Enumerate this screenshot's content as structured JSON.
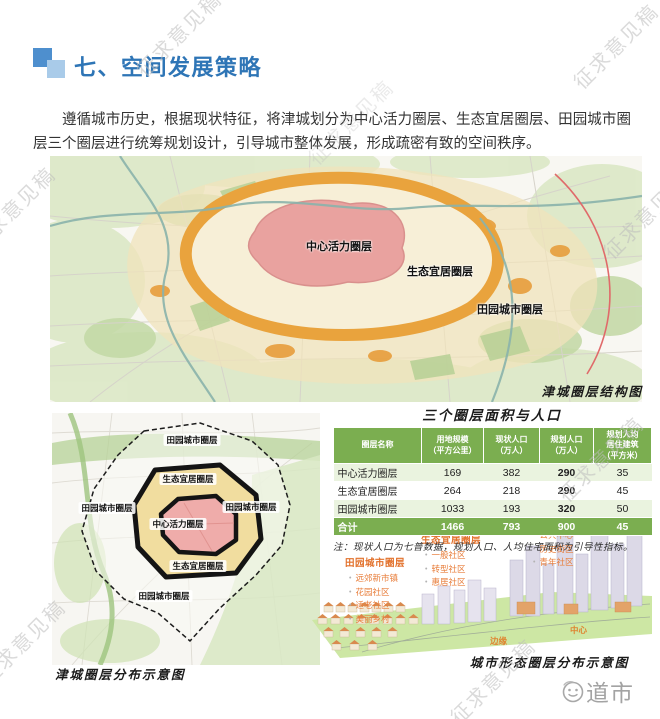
{
  "watermark": {
    "text": "征求意见稿"
  },
  "colors": {
    "accent_blue": "#2e75b6",
    "table_green": "#7bae50",
    "highlight_orange": "#e2702a"
  },
  "header": {
    "title": "七、空间发展策略"
  },
  "intro": {
    "text": "遵循城市历史，根据现状特征，将津城划分为中心活力圈层、生态宜居圈层、田园城市圈层三个圈层进行统筹规划设计，引导城市整体发展，形成疏密有致的空间秩序。"
  },
  "figures": {
    "main_map": {
      "label_center": "中心活力圈层",
      "label_eco": "生态宜居圈层",
      "label_garden": "田园城市圈层",
      "caption": "津城圈层结构图"
    },
    "left_map": {
      "label_garden_top": "田园城市圈层",
      "label_eco_top": "生态宜居圈层",
      "label_garden_left": "田园城市圈层",
      "label_garden_right": "田园城市圈层",
      "label_center": "中心活力圈层",
      "label_eco_bottom": "生态宜居圈层",
      "label_garden_bottom": "田园城市圈层",
      "caption": "津城圈层分布示意图"
    },
    "form_diagram": {
      "groups": [
        {
          "title": "田园城市圈层",
          "items": [
            "远郊新市镇",
            "花园社区",
            "适老社区",
            "美丽乡村"
          ]
        },
        {
          "title": "生态宜居圈层",
          "items": [
            "一般社区",
            "转型社区",
            "惠居社区"
          ]
        },
        {
          "title": "中心活力圈层",
          "items": [
            "公共中心",
            "历史街区",
            "青年社区"
          ]
        }
      ],
      "ground_labels": {
        "edge": "边缘",
        "center": "中心"
      },
      "caption": "城市形态圈层分布示意图"
    }
  },
  "table": {
    "title": "三个圈层面积与人口",
    "headers": [
      "圈层名称",
      "用地规模\n（平方公里）",
      "现状人口\n（万人）",
      "规划人口\n（万人）",
      "规划人均\n居住建筑\n（平方米）"
    ],
    "rows": [
      {
        "cells": [
          "中心活力圈层",
          "169",
          "382",
          "290",
          "35"
        ]
      },
      {
        "cells": [
          "生态宜居圈层",
          "264",
          "218",
          "290",
          "45"
        ]
      },
      {
        "cells": [
          "田园城市圈层",
          "1033",
          "193",
          "320",
          "50"
        ]
      },
      {
        "cells": [
          "合计",
          "1466",
          "793",
          "900",
          "45"
        ]
      }
    ],
    "note": "注：现状人口为七普数据，规划人口、人均住宅面积为引导性指标。"
  },
  "footer": {
    "logo_text": "道市"
  }
}
